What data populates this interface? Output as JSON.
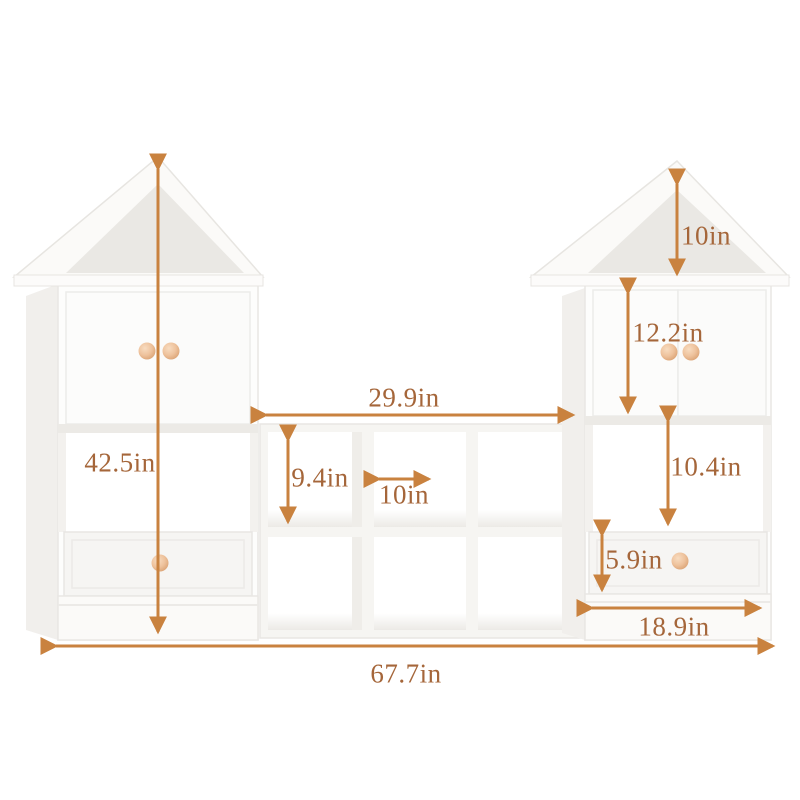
{
  "diagram": {
    "type": "furniture-dimension-diagram",
    "subject": "kids house-shaped bookcase with cube storage",
    "unit": "in"
  },
  "dimensions": {
    "total_width": "67.7in",
    "left_tower_height": "42.5in",
    "middle_shelf_width": "29.9in",
    "cube_height": "9.4in",
    "cube_width": "10in",
    "roof_height": "10in",
    "right_door_height": "12.2in",
    "right_shelf_height": "10.4in",
    "drawer_height": "5.9in",
    "right_tower_width": "18.9in"
  },
  "colors": {
    "dimension_line": "#c9823f",
    "dimension_text": "#a5663a",
    "furniture_white": "#fdfdfc",
    "panel_shadow": "#eae8e4",
    "knob": "#e9b98e",
    "background": "#ffffff"
  }
}
